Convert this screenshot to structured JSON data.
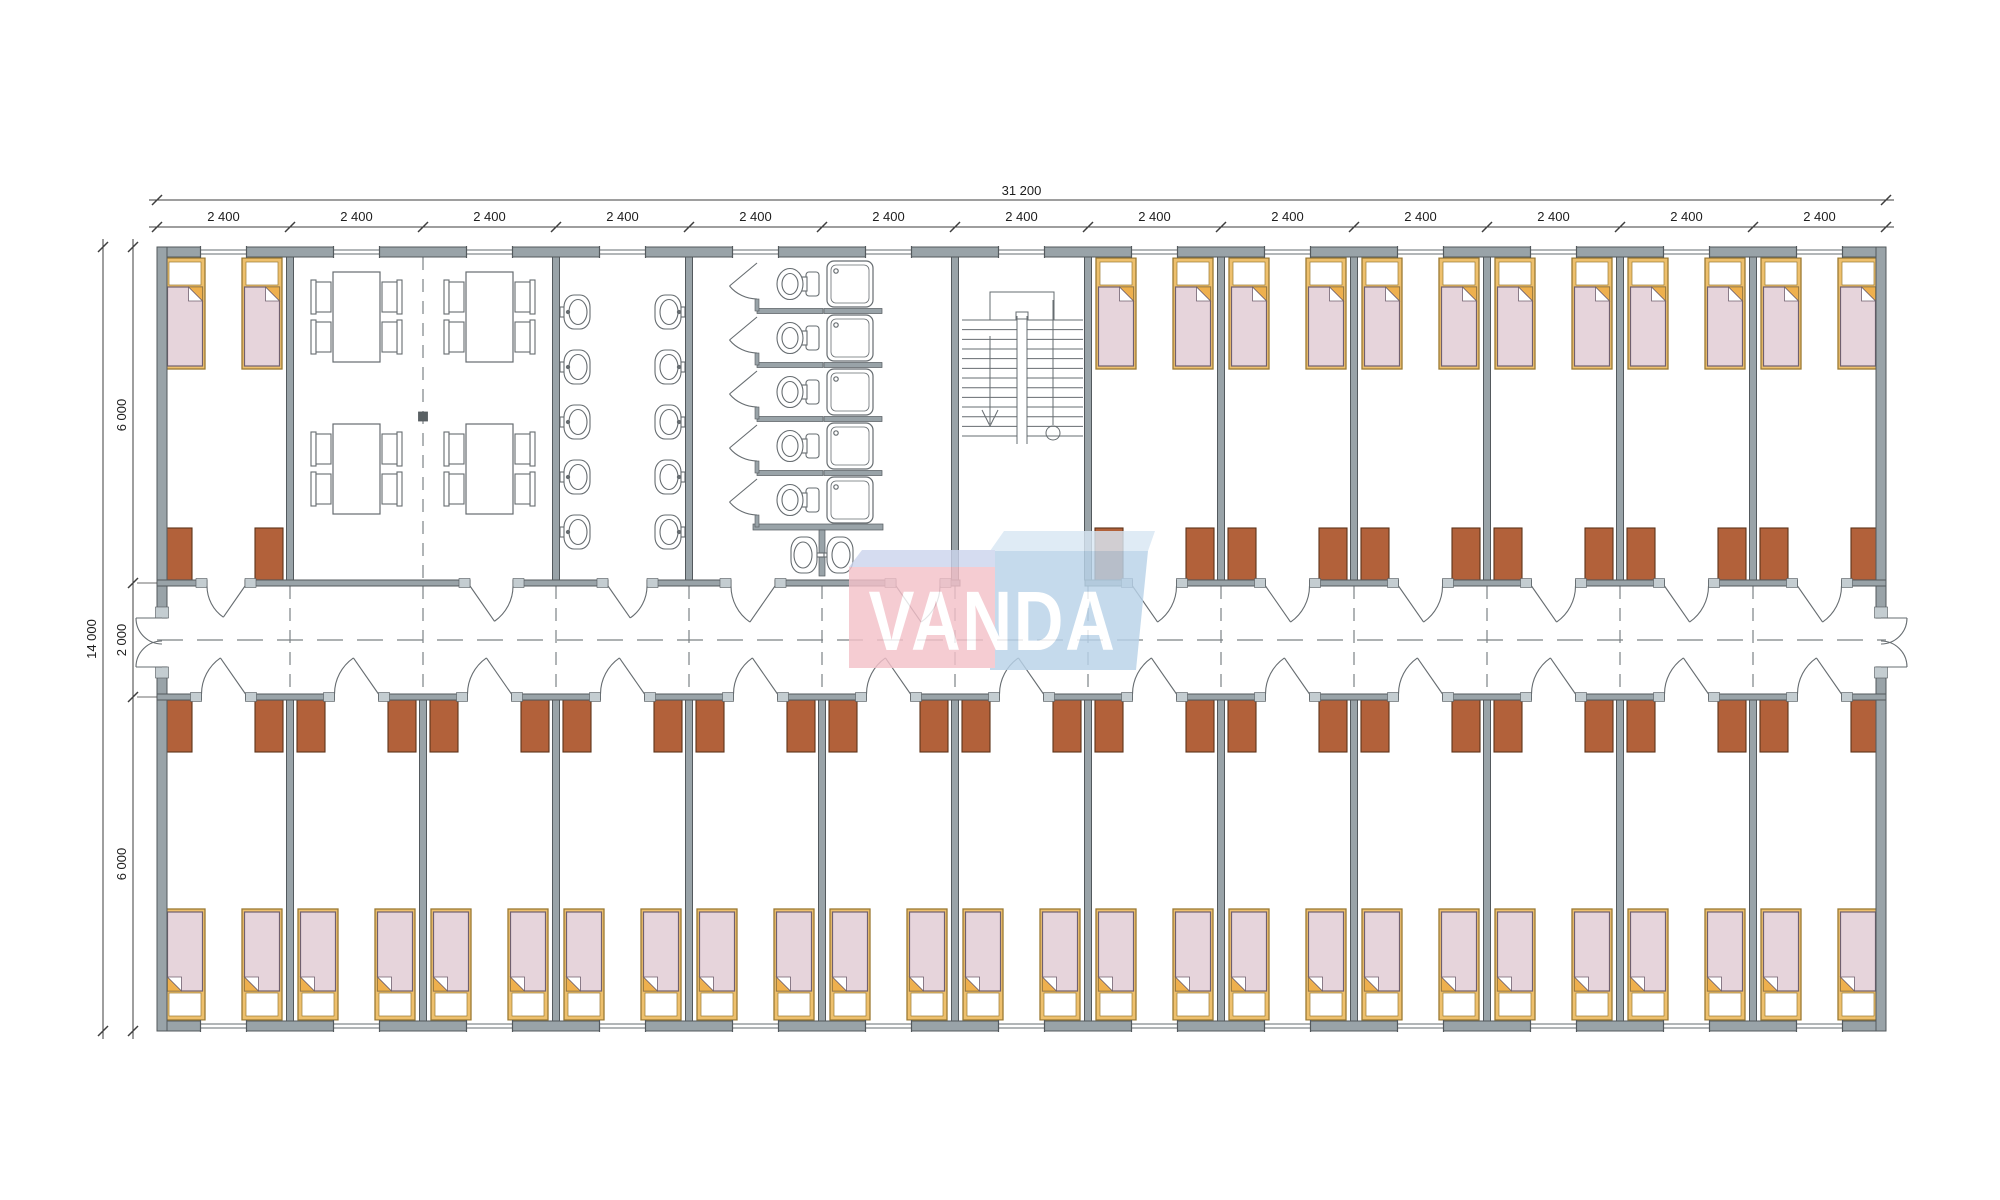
{
  "drawing": {
    "type": "modular-building-floor-plan",
    "units": "mm",
    "description": "Dormitory container building plan: bedrooms, dining room, washroom, WC/shower block, stairwell, central corridor"
  },
  "dimensions": {
    "overall_width": "31 200",
    "module_width": "2 400",
    "module_count": 13,
    "overall_depth": "14 000",
    "depth_segments": [
      "6 000",
      "2 000",
      "6 000"
    ]
  },
  "logo": {
    "text": "VANDA",
    "pink": "#f3c1c9",
    "pink_top": "#ccd5ed",
    "blue": "#b9d3e9",
    "blue_top": "#d8e7f4",
    "letter_color": "#ffffff"
  },
  "palette": {
    "paper": "#ffffff",
    "wall": "#99a3a8",
    "wall_stroke": "#53595d",
    "jamb": "#c4cdd1",
    "line": "#666c70",
    "dash": "#7c8285",
    "dim_line": "#3e3e3e",
    "dim_text": "#1d1d1d",
    "wardrobe": "#b2613a",
    "wardrobe_stroke": "#5d3319",
    "bed_frame": "#eec06d",
    "bed_frame_stroke": "#9b7a33",
    "mattress": "#e6d4db",
    "mattress_stroke": "#70606f",
    "fold": "#eeb04e",
    "column": "#5a6164",
    "fixture_fill": "#ffffff"
  },
  "rooms": {
    "top": [
      {
        "type": "bedroom",
        "span": 1,
        "beds": 2,
        "wardrobes": 2
      },
      {
        "type": "dining",
        "span": 2,
        "tables": 4,
        "chairs_per_table": 4
      },
      {
        "type": "washroom",
        "span": 1,
        "basins": 10
      },
      {
        "type": "sanitary",
        "span": 2,
        "wc_stalls": 5,
        "showers": 5,
        "basins": 2
      },
      {
        "type": "stairs",
        "span": 1
      },
      {
        "type": "bedroom",
        "span": 1,
        "beds": 2,
        "wardrobes": 2
      },
      {
        "type": "bedroom",
        "span": 1,
        "beds": 2,
        "wardrobes": 2
      },
      {
        "type": "bedroom",
        "span": 1,
        "beds": 2,
        "wardrobes": 2
      },
      {
        "type": "bedroom",
        "span": 1,
        "beds": 2,
        "wardrobes": 2
      },
      {
        "type": "bedroom",
        "span": 1,
        "beds": 2,
        "wardrobes": 2
      },
      {
        "type": "bedroom",
        "span": 1,
        "beds": 2,
        "wardrobes": 2
      }
    ],
    "bottom": [
      {
        "type": "bedroom",
        "span": 1,
        "beds": 2,
        "wardrobes": 2
      },
      {
        "type": "bedroom",
        "span": 1,
        "beds": 2,
        "wardrobes": 2
      },
      {
        "type": "bedroom",
        "span": 1,
        "beds": 2,
        "wardrobes": 2
      },
      {
        "type": "bedroom",
        "span": 1,
        "beds": 2,
        "wardrobes": 2
      },
      {
        "type": "bedroom",
        "span": 1,
        "beds": 2,
        "wardrobes": 2
      },
      {
        "type": "bedroom",
        "span": 1,
        "beds": 2,
        "wardrobes": 2
      },
      {
        "type": "bedroom",
        "span": 1,
        "beds": 2,
        "wardrobes": 2
      },
      {
        "type": "bedroom",
        "span": 1,
        "beds": 2,
        "wardrobes": 2
      },
      {
        "type": "bedroom",
        "span": 1,
        "beds": 2,
        "wardrobes": 2
      },
      {
        "type": "bedroom",
        "span": 1,
        "beds": 2,
        "wardrobes": 2
      },
      {
        "type": "bedroom",
        "span": 1,
        "beds": 2,
        "wardrobes": 2
      },
      {
        "type": "bedroom",
        "span": 1,
        "beds": 2,
        "wardrobes": 2
      },
      {
        "type": "bedroom",
        "span": 1,
        "beds": 2,
        "wardrobes": 2
      }
    ]
  }
}
